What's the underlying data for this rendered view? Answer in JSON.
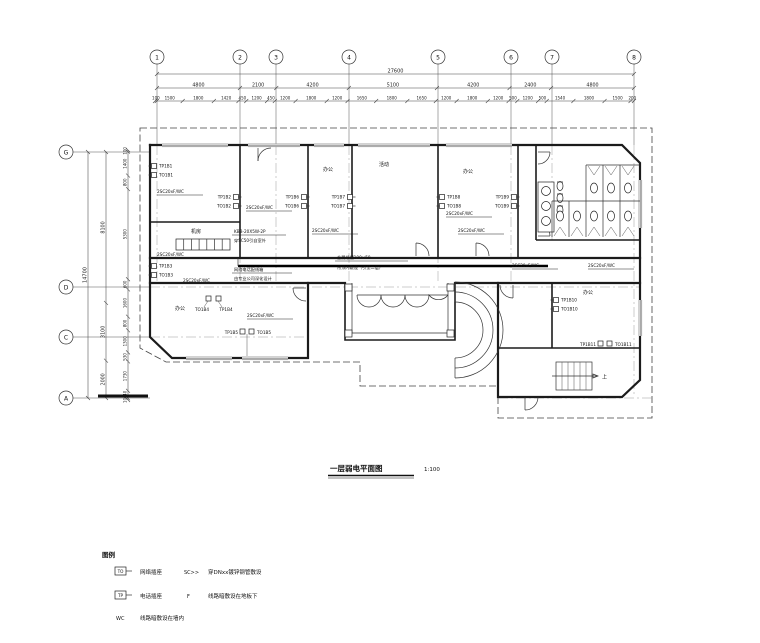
{
  "title": {
    "text": "一层弱电平面图",
    "scale": "1:100"
  },
  "grid": {
    "top": [
      "1",
      "2",
      "3",
      "4",
      "5",
      "6",
      "7",
      "8"
    ],
    "left": [
      "G",
      "D",
      "C",
      "A"
    ]
  },
  "dims": {
    "top_total": [
      "27600"
    ],
    "top_major": [
      "4800",
      "2100",
      "4200",
      "5100",
      "4200",
      "2400",
      "4800"
    ],
    "top_minor": [
      "100",
      "1500",
      "1800",
      "1420",
      "450",
      "1200",
      "450",
      "1200",
      "1800",
      "1200",
      "1650",
      "1800",
      "1650",
      "1200",
      "1800",
      "1200",
      "500",
      "1200",
      "500",
      "1540",
      "1800",
      "1500",
      "200"
    ],
    "left_total": [
      "14700"
    ],
    "left_major": [
      "8100",
      "3100",
      "2000"
    ],
    "left_minor": [
      "100",
      "1400",
      "800",
      "5300",
      "600",
      "1600",
      "800",
      "1300",
      "530",
      "1730",
      "440",
      "100"
    ]
  },
  "wire": "2SC20xF/WC",
  "outlets": [
    {
      "tp": "TP1B1",
      "to": "TO1B1"
    },
    {
      "tp": "TP1B2",
      "to": "TO1B2"
    },
    {
      "tp": "TP1B3",
      "to": "TO1B3"
    },
    {
      "tp": "TP1B4",
      "to": "TO1B4"
    },
    {
      "tp": "TP1B5",
      "to": "TO1B5"
    },
    {
      "tp": "TP1B6",
      "to": "TO1B6"
    },
    {
      "tp": "TP1B7",
      "to": "TO1B7"
    },
    {
      "tp": "TP1B8",
      "to": "TO1B8"
    },
    {
      "tp": "TP1B9",
      "to": "TO1B9"
    },
    {
      "tp": "TP1B10",
      "to": "TO1B10"
    },
    {
      "tp": "TP1B11",
      "to": "TO1B11"
    }
  ],
  "rooms": {
    "equip": "机房",
    "office3": "办公",
    "activity": "活动",
    "office5": "办公",
    "lower_left": "办公",
    "wing": "办公",
    "stair_up": "上"
  },
  "notes": {
    "kbb1": "KBB-20X5W-2P",
    "kbb2": "穿SC50引自室外",
    "box1": "网络电话配线箱",
    "box2": "由专业公司深化设计",
    "trunk1": "金属线槽100×50",
    "trunk2": "吊顶内敷设（引至二层）"
  },
  "legend": {
    "header": "图例",
    "items": [
      {
        "symbol": "TO",
        "label": "网络插座"
      },
      {
        "symbol": "TP",
        "label": "电话插座"
      },
      {
        "symbol": "WC",
        "label": "线路暗敷设在墙内"
      },
      {
        "symbol": "SC>>",
        "label": "穿DNxx镀锌钢管敷设"
      },
      {
        "symbol": "F",
        "label": "线路暗敷设在地板下"
      }
    ]
  }
}
